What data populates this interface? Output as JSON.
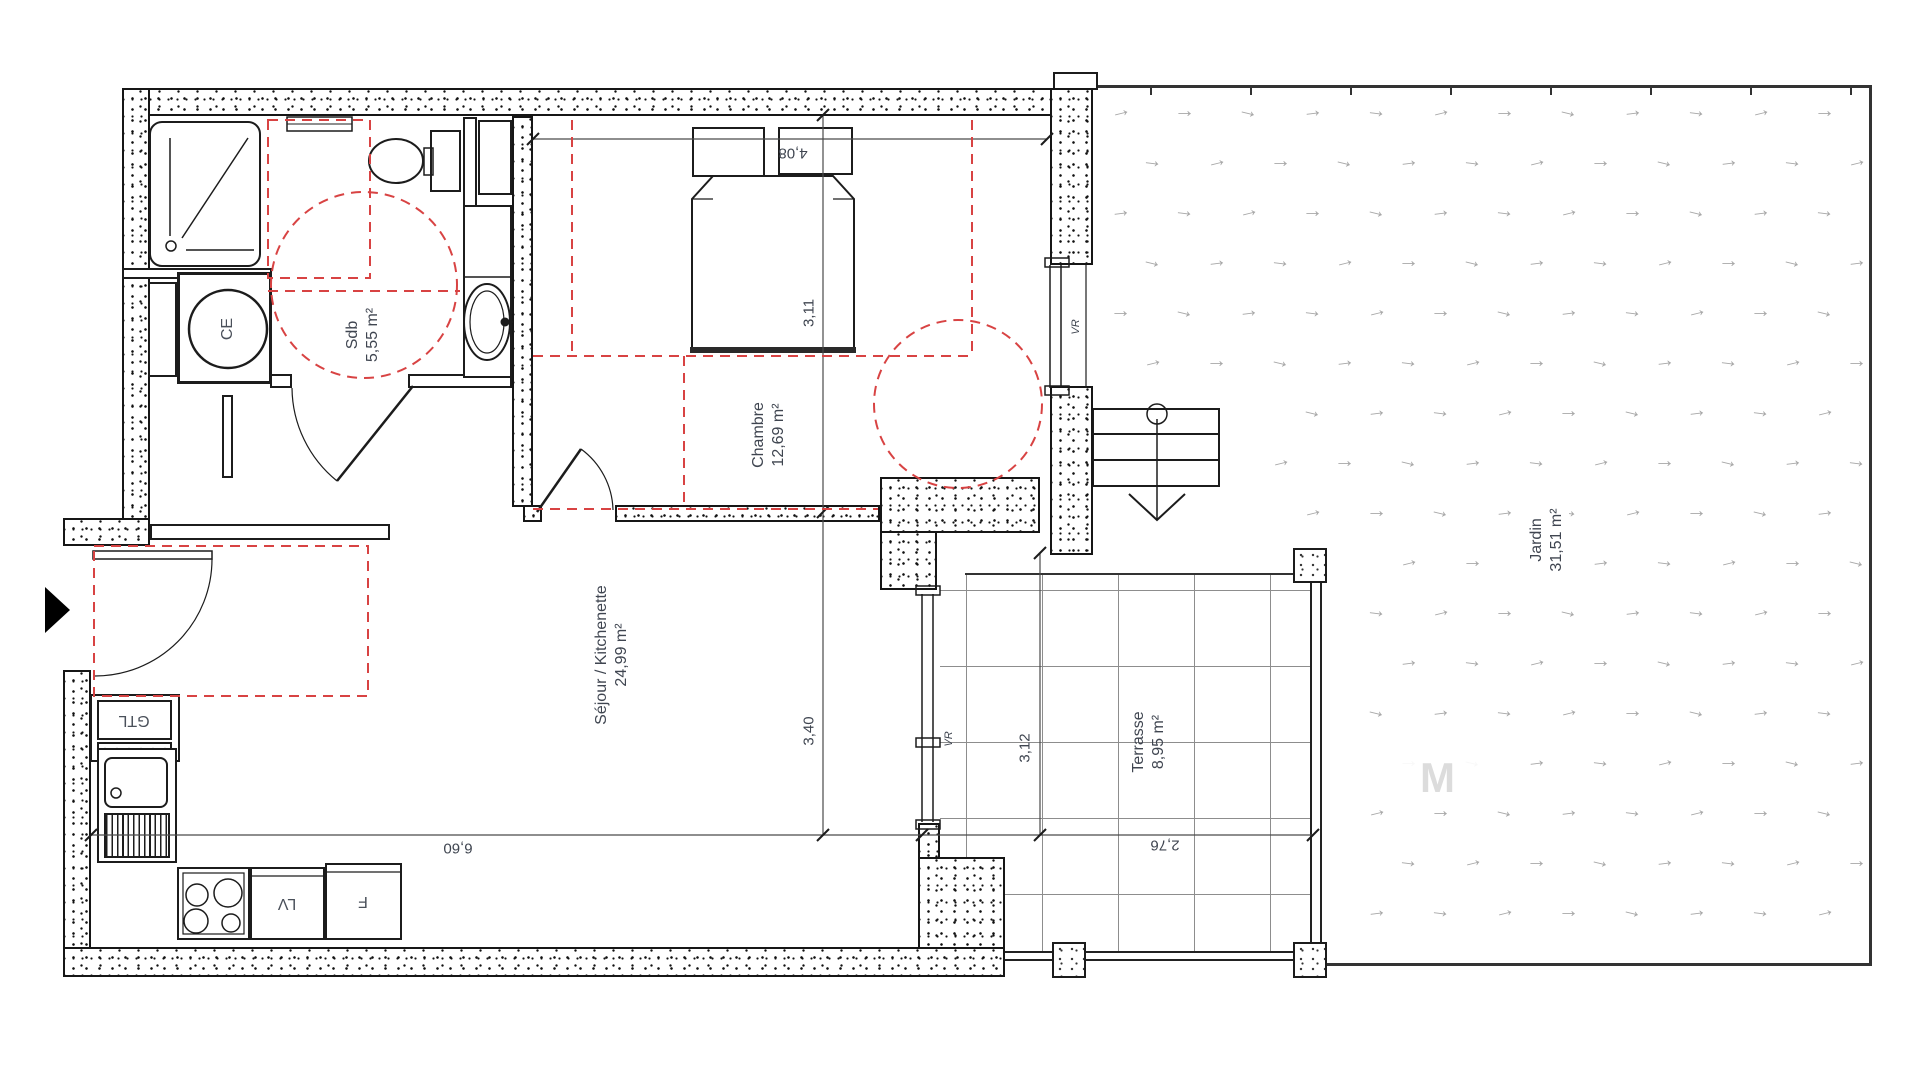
{
  "plan": {
    "rooms": [
      {
        "id": "sdb",
        "name": "Sdb",
        "area": "5,55 m²"
      },
      {
        "id": "chambre",
        "name": "Chambre",
        "area": "12,69 m²"
      },
      {
        "id": "sejour",
        "name": "Séjour / Kitchenette",
        "area": "24,99 m²"
      },
      {
        "id": "terrasse",
        "name": "Terrasse",
        "area": "8,95 m²"
      },
      {
        "id": "jardin",
        "name": "Jardin",
        "area": "31,51 m²"
      }
    ],
    "dims": [
      {
        "id": "chambre-width",
        "value": "4,08"
      },
      {
        "id": "chambre-depth",
        "value": "3,11"
      },
      {
        "id": "sejour-depth",
        "value": "3,40"
      },
      {
        "id": "sejour-width",
        "value": "6,60"
      },
      {
        "id": "terrasse-depth",
        "value": "3,12"
      },
      {
        "id": "terrasse-width",
        "value": "2,76"
      }
    ],
    "tags": {
      "ce": "CE",
      "gtl": "GTL",
      "lv": "LV",
      "f": "F",
      "vr": "VR"
    },
    "colors": {
      "accessibility_zone": "#d84343",
      "wall_ink": "#1c1c1c",
      "label_ink": "#3f4550",
      "garden_symbol_color": "#a8a8a8"
    },
    "garden_symbol": "→"
  },
  "watermark": "M"
}
